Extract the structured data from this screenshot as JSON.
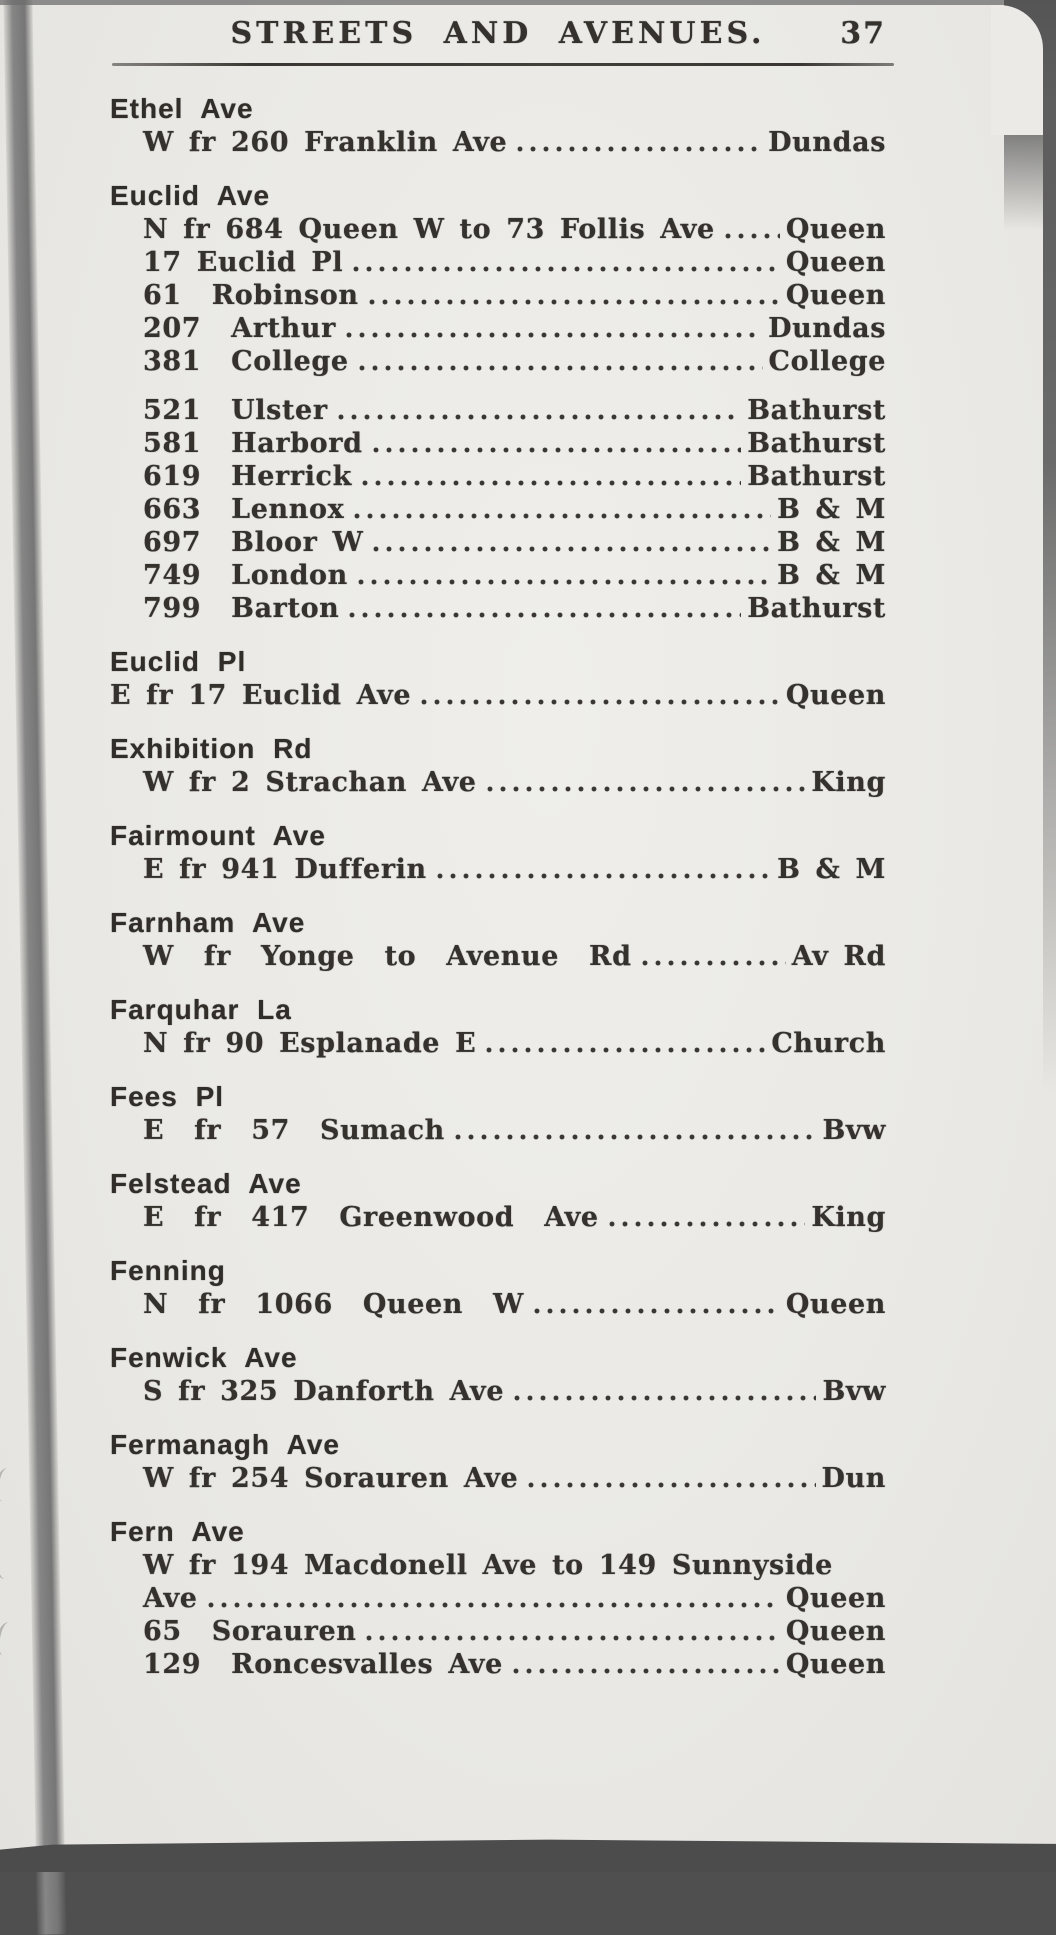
{
  "page": {
    "header_title": "STREETS AND AVENUES.",
    "page_number": "37"
  },
  "colors": {
    "paper": "#eae9e5",
    "ink": "#35312d",
    "scan_edge": "#4f4f4f"
  },
  "entries": [
    {
      "heading": "Ethel Ave",
      "lines": [
        {
          "text": "W fr 260 Franklin Ave",
          "dest": "Dundas"
        }
      ]
    },
    {
      "heading": "Euclid Ave",
      "lines": [
        {
          "text": "N fr 684 Queen W to 73 Follis Ave",
          "dest": "Queen"
        },
        {
          "text": "17 Euclid Pl",
          "dest": "Queen"
        },
        {
          "text": "61  Robinson",
          "dest": "Queen"
        },
        {
          "text": "207  Arthur",
          "dest": "Dundas"
        },
        {
          "text": "381  College",
          "dest": "College"
        }
      ]
    },
    {
      "heading": "",
      "lines": [
        {
          "text": "521  Ulster",
          "dest": "Bathurst"
        },
        {
          "text": "581  Harbord",
          "dest": "Bathurst"
        },
        {
          "text": "619  Herrick",
          "dest": "Bathurst"
        },
        {
          "text": "663  Lennox",
          "dest": "B & M"
        },
        {
          "text": "697  Bloor W",
          "dest": "B & M"
        },
        {
          "text": "749  London",
          "dest": "B & M"
        },
        {
          "text": "799  Barton",
          "dest": "Bathurst"
        }
      ]
    },
    {
      "heading": "Euclid Pl",
      "lines": [
        {
          "text": "E fr 17 Euclid Ave",
          "dest": "Queen"
        }
      ]
    },
    {
      "heading": "Exhibition Rd",
      "lines": [
        {
          "text": "W fr 2 Strachan Ave",
          "dest": "King"
        }
      ]
    },
    {
      "heading": "Fairmount Ave",
      "lines": [
        {
          "text": "E fr 941 Dufferin",
          "dest": "B & M"
        }
      ]
    },
    {
      "heading": "Farnham Ave",
      "lines": [
        {
          "text": "W  fr  Yonge  to  Avenue  Rd",
          "dest": "Av Rd"
        }
      ]
    },
    {
      "heading": "Farquhar La",
      "lines": [
        {
          "text": "N fr 90 Esplanade E",
          "dest": "Church"
        }
      ]
    },
    {
      "heading": "Fees Pl",
      "lines": [
        {
          "text": "E  fr  57  Sumach",
          "dest": "Bvw"
        }
      ]
    },
    {
      "heading": "Felstead Ave",
      "lines": [
        {
          "text": "E  fr  417  Greenwood  Ave",
          "dest": "King"
        }
      ]
    },
    {
      "heading": "Fenning",
      "lines": [
        {
          "text": "N  fr  1066  Queen  W",
          "dest": "Queen"
        }
      ]
    },
    {
      "heading": "Fenwick Ave",
      "lines": [
        {
          "text": "S fr 325 Danforth Ave",
          "dest": "Bvw"
        }
      ]
    },
    {
      "heading": "Fermanagh Ave",
      "lines": [
        {
          "text": "W fr 254 Sorauren Ave",
          "dest": "Dun"
        }
      ]
    },
    {
      "heading": "Fern Ave",
      "lines": [
        {
          "text": "W fr 194 Macdonell Ave to 149 Sunnyside",
          "dest": ""
        },
        {
          "text": "Ave",
          "dest": "Queen"
        },
        {
          "text": "65  Sorauren",
          "dest": "Queen"
        },
        {
          "text": "129  Roncesvalles Ave",
          "dest": "Queen"
        }
      ]
    }
  ]
}
